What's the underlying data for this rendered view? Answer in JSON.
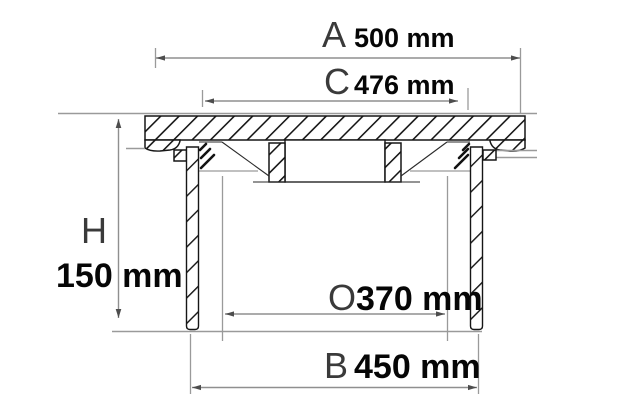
{
  "diagram": {
    "dimensions": {
      "a": {
        "letter": "A",
        "value": "500 mm"
      },
      "c": {
        "letter": "C",
        "value": "476 mm"
      },
      "h": {
        "letter": "H",
        "value": "150 mm"
      },
      "o": {
        "letter": "O",
        "value": "370 mm"
      },
      "b": {
        "letter": "B",
        "value": "450 mm"
      }
    },
    "colors": {
      "line": "#161616",
      "dimension_line": "#8f8f8f",
      "label_letter": "#3a3a3a",
      "label_value": "#060606",
      "background": "#ffffff"
    }
  }
}
